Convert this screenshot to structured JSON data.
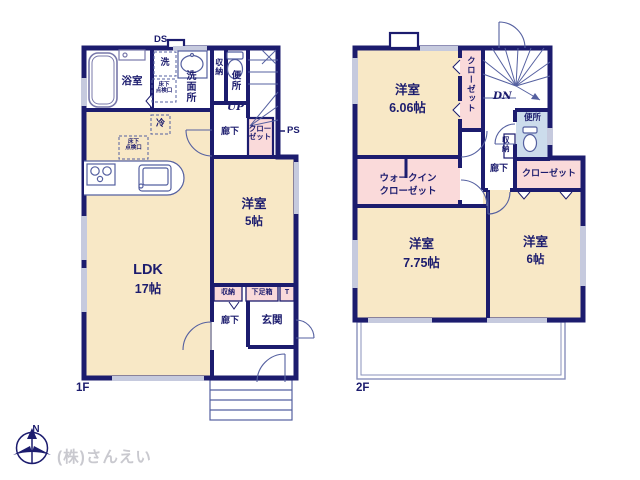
{
  "floor1": {
    "ds": "DS",
    "bath": "浴室",
    "laundry": "洗",
    "washroom": "洗面所",
    "hatch_line1": "床下",
    "hatch_line2": "点検口",
    "fridge": "冷",
    "storage": "収納",
    "toilet": "便所",
    "up": "UP",
    "hallway": "廊下",
    "closet_line1": "クロー",
    "closet_line2": "ゼット",
    "ps": "PS",
    "ldk": "LDK",
    "ldk_size": "17帖",
    "bedroom": "洋室",
    "bedroom_size": "5帖",
    "entrance_storage": "収納",
    "shoe_box": "下足箱",
    "shoe_t": "T",
    "entrance_hallway": "廊下",
    "entrance": "玄関",
    "label": "1F"
  },
  "floor2": {
    "bedroom1": "洋室",
    "bedroom1_size": "6.06帖",
    "closet_side": "クローゼット",
    "dn": "DN",
    "toilet": "便所",
    "storage": "収納",
    "hallway": "廊下",
    "closet_right": "クローゼット",
    "wic_line1": "ウォークイン",
    "wic_line2": "クローゼット",
    "bedroom2": "洋室",
    "bedroom2_size": "7.75帖",
    "bedroom3": "洋室",
    "bedroom3_size": "6帖",
    "label": "2F"
  },
  "footer": {
    "compass": "N",
    "company": "(株)さんえい"
  },
  "colors": {
    "wall": "#1c1c6e",
    "room": "#f8e8c6",
    "closet": "#fadada",
    "toilet_floor": "#ccdcec",
    "window": "#c6cade",
    "fixture": "#5560a0"
  }
}
